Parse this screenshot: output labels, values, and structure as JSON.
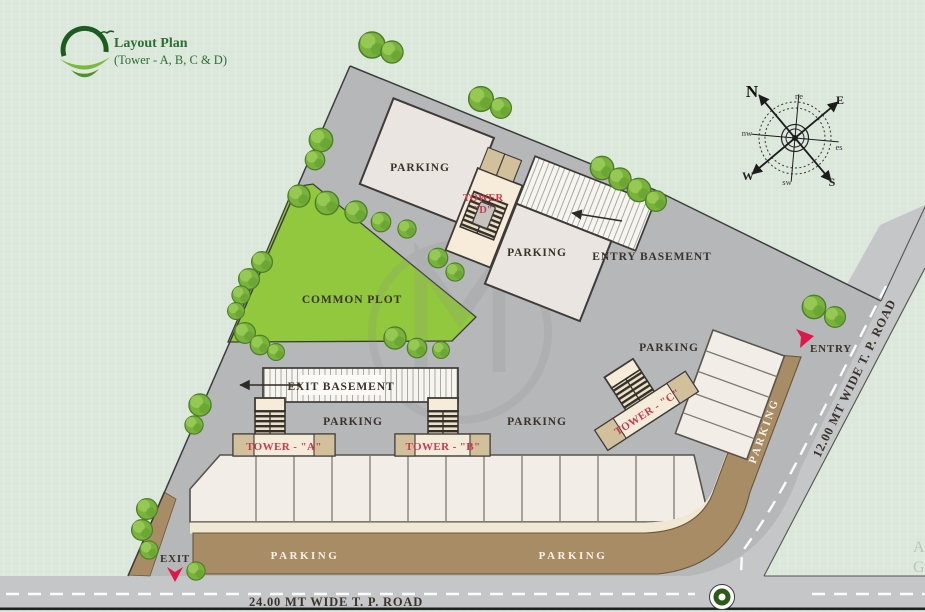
{
  "title": {
    "line1": "Layout Plan",
    "line2": "(Tower - A, B, C & D)"
  },
  "labels": {
    "parking": "PARKING",
    "common_plot": "COMMON PLOT",
    "entry_basement": "ENTRY BASEMENT",
    "exit_basement": "EXIT BASEMENT",
    "entry": "ENTRY",
    "exit": "EXIT"
  },
  "towers": {
    "a": "TOWER - \"A\"",
    "b": "TOWER - \"B\"",
    "c": "TOWER - \"C\"",
    "d_line1": "TOWER",
    "d_line2": "\"D\""
  },
  "roads": {
    "bottom": "24.00 MT WIDE T. P. ROAD",
    "side": "12.00 MT WIDE T. P. ROAD"
  },
  "compass": {
    "n": "N",
    "e": "E",
    "s": "S",
    "w": "W",
    "ne": "ne",
    "se": "es",
    "sw": "sw",
    "nw": "nw"
  },
  "watermark": {
    "monogram": "M",
    "edge_letter_1": "A",
    "edge_letter_2": "G"
  },
  "colors": {
    "background": "#dde8dd",
    "site_gray": "#b6b7b9",
    "road_gray": "#c5c6c8",
    "building": "#eae5e0",
    "stall": "#f2ede6",
    "cream": "#f6ecd9",
    "tan": "#d2bf9c",
    "brown_parking": "#a78c66",
    "plot_green": "#92c83e",
    "tree_green": "#79b23c",
    "label_red": "#c93a50",
    "text_dark": "#3a332b",
    "logo_green": "#2d6e31"
  }
}
